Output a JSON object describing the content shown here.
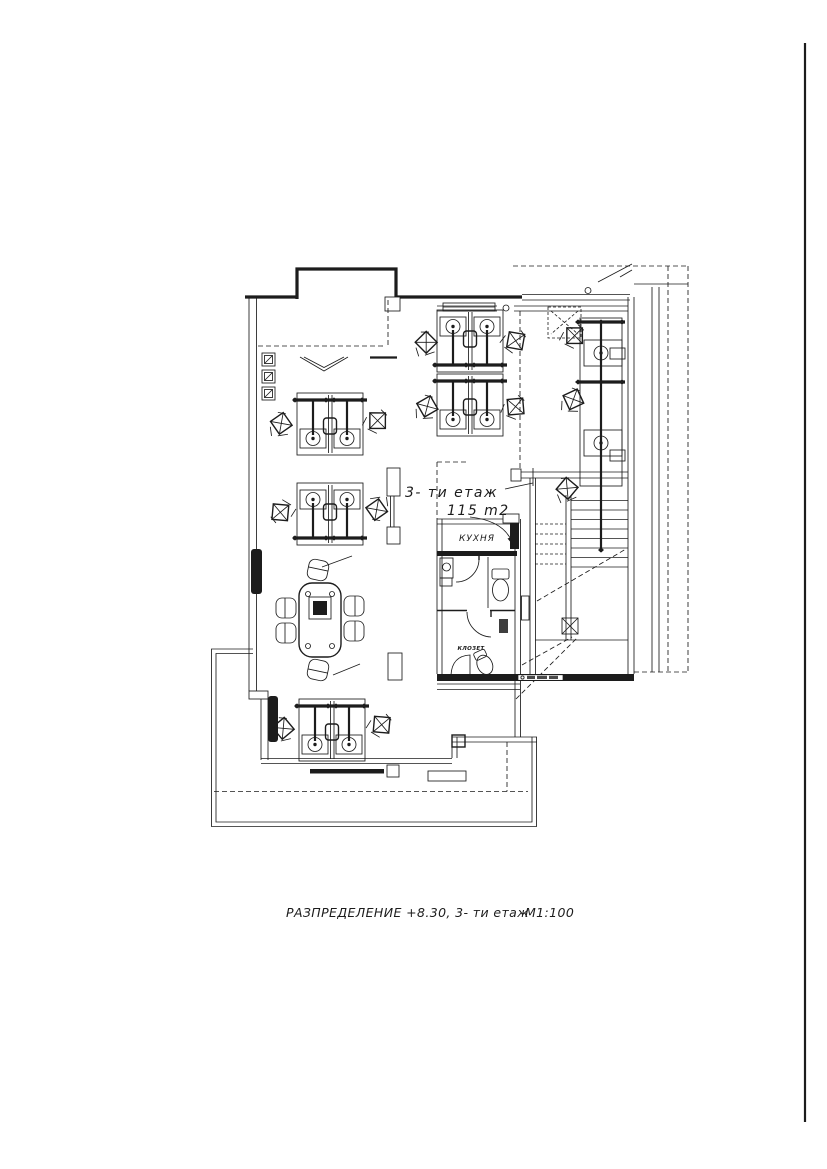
{
  "page": {
    "background": "#ffffff",
    "ink": "#1c1c1c"
  },
  "annotations": {
    "floor_label": "3- ти етаж",
    "area_label": "115 m2"
  },
  "rooms": {
    "kitchen": "КУХНЯ",
    "wc": "КЛОЗЕТ"
  },
  "title_block": {
    "title": "РАЗПРЕДЕЛЕНИЕ  +8.30,  3- ти етаж",
    "scale": "М1:100"
  }
}
